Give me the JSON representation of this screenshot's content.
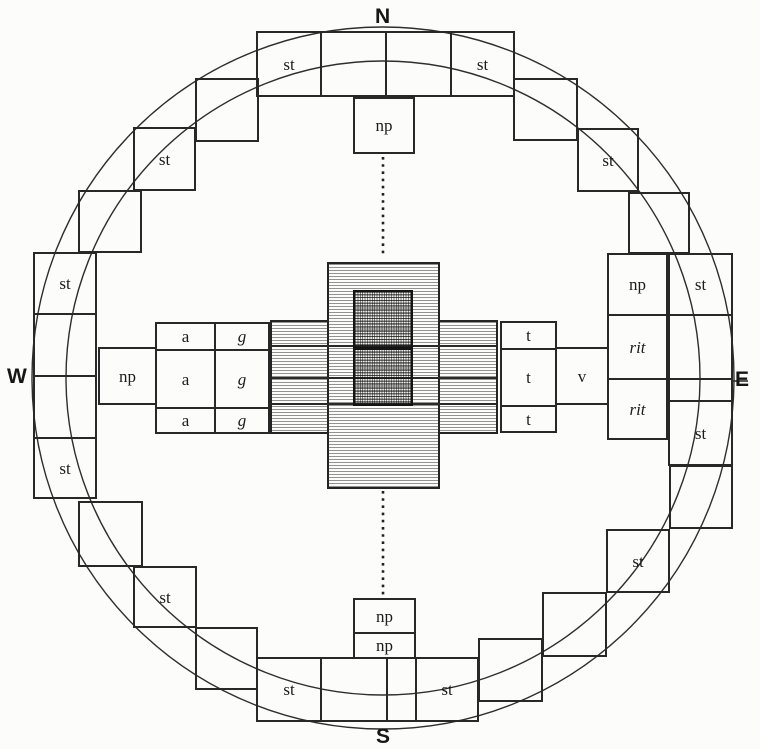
{
  "colors": {
    "paper": "#fcfcfa",
    "ink": "#282828",
    "hatch_light": "#8a8a8a",
    "sanctum_dark": "#3a3a3a"
  },
  "cardinals": {
    "north": "N",
    "east": "E",
    "south": "S",
    "west": "W"
  },
  "ring": {
    "north_row": [
      "st",
      "",
      "",
      "st"
    ],
    "ne_stair": [
      "",
      "st",
      ""
    ],
    "east_col": [
      "st",
      "",
      "",
      "st"
    ],
    "se_stair": [
      "",
      "",
      "st",
      ""
    ],
    "south_row": [
      "st",
      "",
      "",
      "st"
    ],
    "sw_stair": [
      "",
      "st",
      ""
    ],
    "west_col": [
      "st",
      "",
      "",
      "st"
    ],
    "nw_stair": [
      "",
      "st",
      ""
    ]
  },
  "gates": {
    "north_np": "np",
    "west_np": "np",
    "east_np": "np",
    "south_np_outer": "np",
    "south_np_inner": "np"
  },
  "east_block": {
    "rit_upper": "rit",
    "rit_lower": "rit"
  },
  "west_arm": {
    "rows": [
      [
        "a",
        "g"
      ],
      [
        "a",
        "g"
      ],
      [
        "a",
        "g"
      ]
    ]
  },
  "east_arm": {
    "t_cells": [
      "t",
      "t",
      "t"
    ],
    "v_cell": "v"
  }
}
